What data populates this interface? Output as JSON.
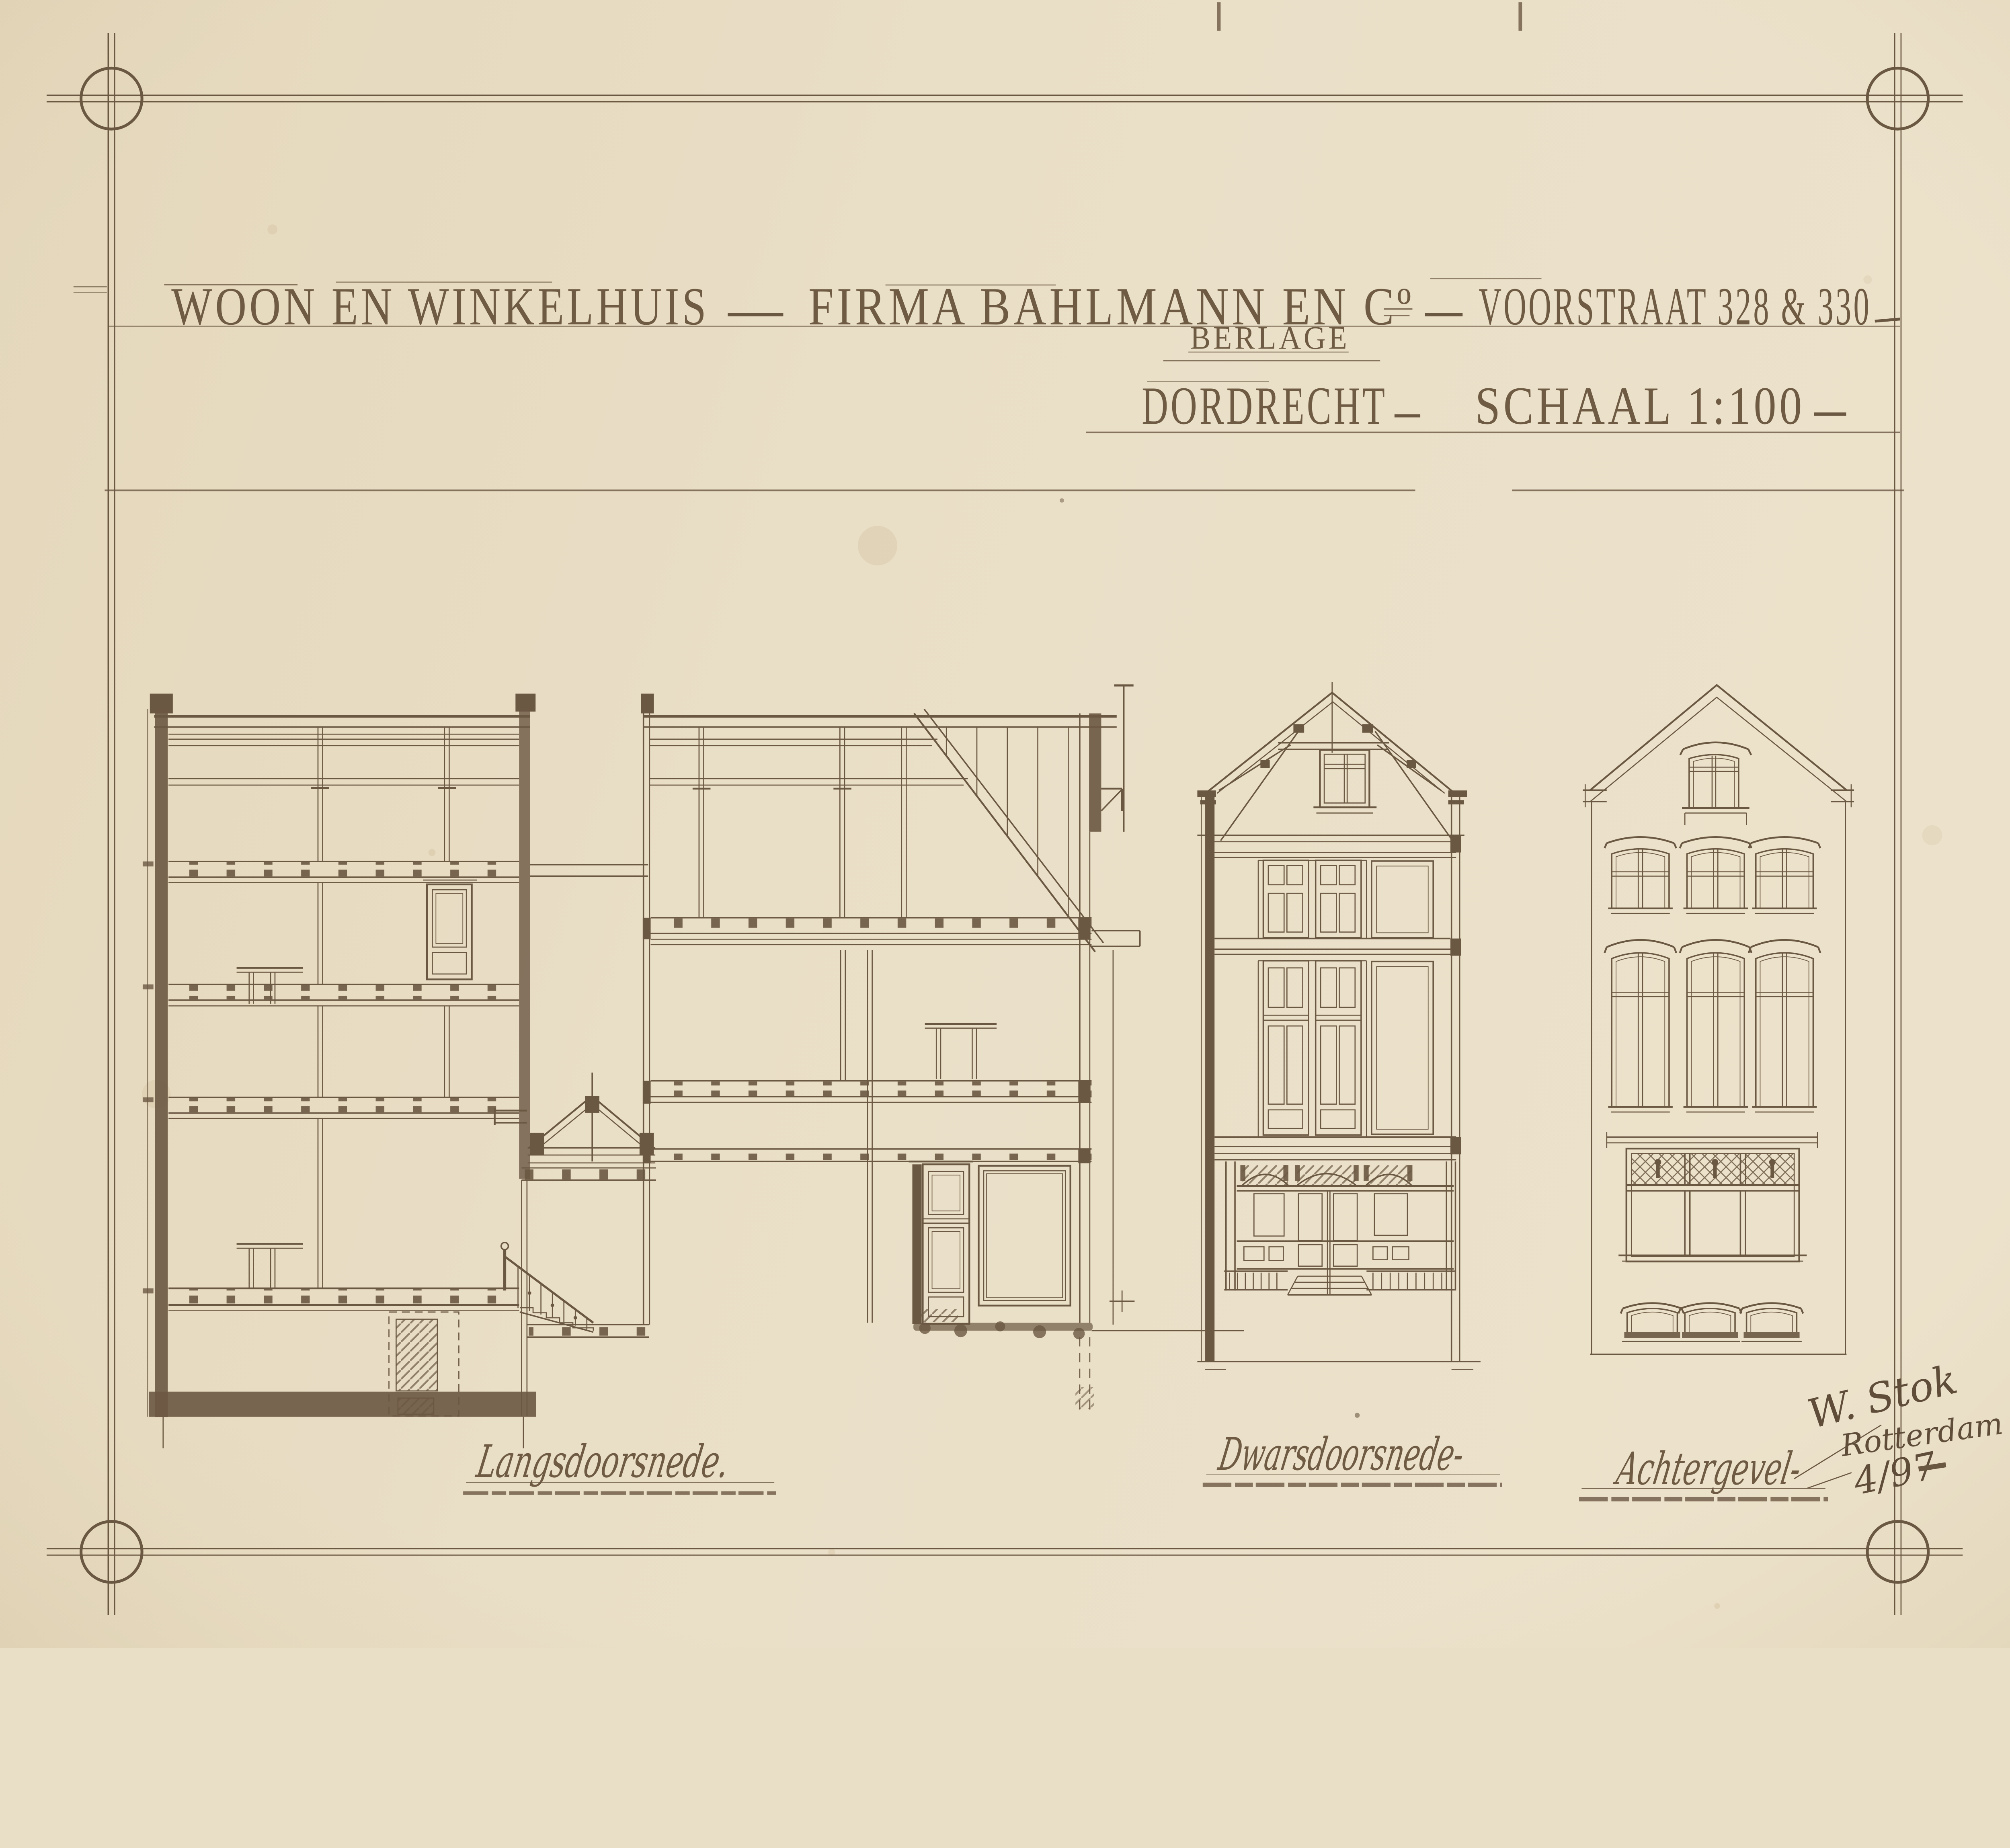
{
  "sheet": {
    "kind": "architectural drawing, pen and ink on paper",
    "colors": {
      "paper": "#e9dec6",
      "ink": "#6b5843"
    }
  },
  "title_block": {
    "project": "WOON EN WINKELHUIS",
    "client": "FIRMA BAHLMANN EN Cº",
    "address": "VOORSTRAAT 328 & 330",
    "annotation": "BERLAGE",
    "city": "DORDRECHT",
    "scale": "SCHAAL 1:100"
  },
  "figures": [
    {
      "label": "Langsdoorsnede."
    },
    {
      "label": "Dwarsdoorsnede-"
    },
    {
      "label": "Achtergevel-"
    }
  ],
  "signature": {
    "name": "W. Stok",
    "place": "Rotterdam",
    "date": "4/97"
  }
}
